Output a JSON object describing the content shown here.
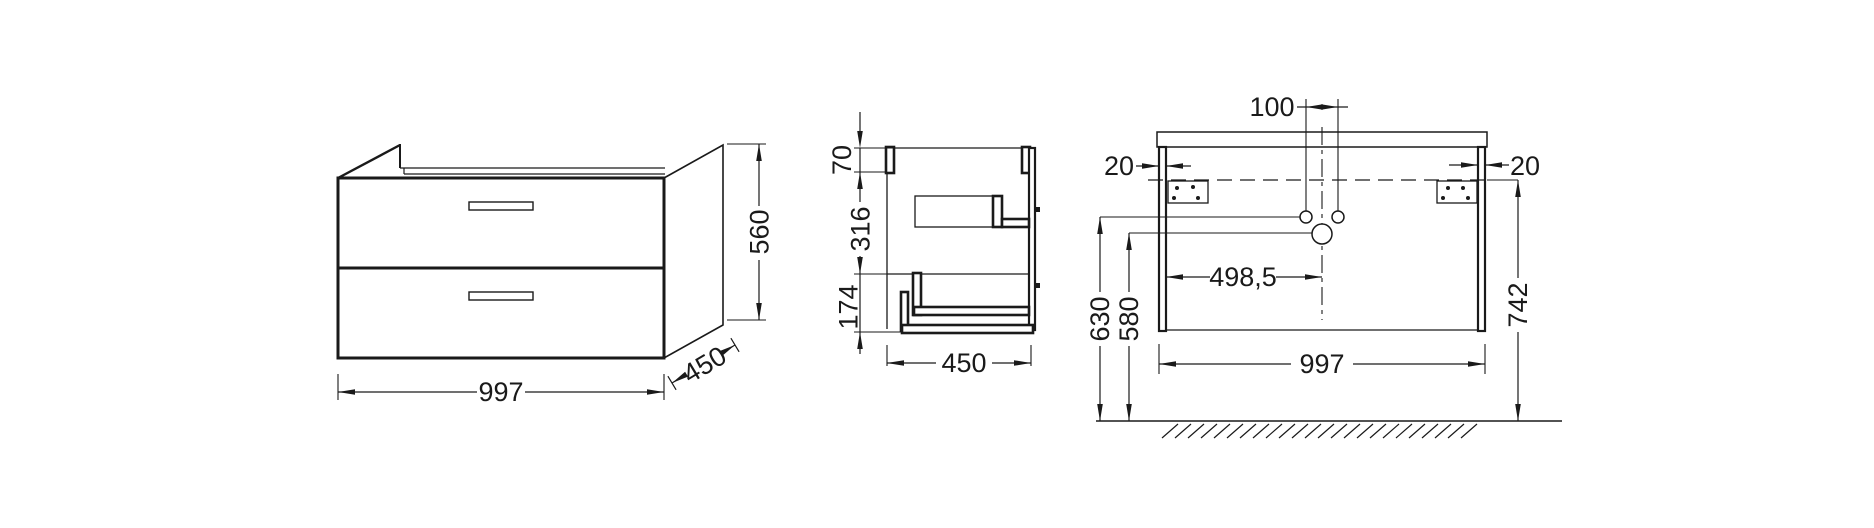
{
  "colors": {
    "background": "#ffffff",
    "line": "#1a1a1a",
    "text": "#1a1a1a"
  },
  "front_view": {
    "width": "997",
    "depth": "450",
    "height": "560"
  },
  "side_view": {
    "top_rail_height": "70",
    "upper_section_height": "316",
    "lower_section_height": "174",
    "depth": "450"
  },
  "installation_view": {
    "tap_hole_spacing": "100",
    "left_panel_thickness": "20",
    "right_panel_thickness": "20",
    "drain_centre_offset": "498,5",
    "tap_holes_height": "630",
    "drain_height": "580",
    "mounting_height": "742",
    "width": "997"
  }
}
